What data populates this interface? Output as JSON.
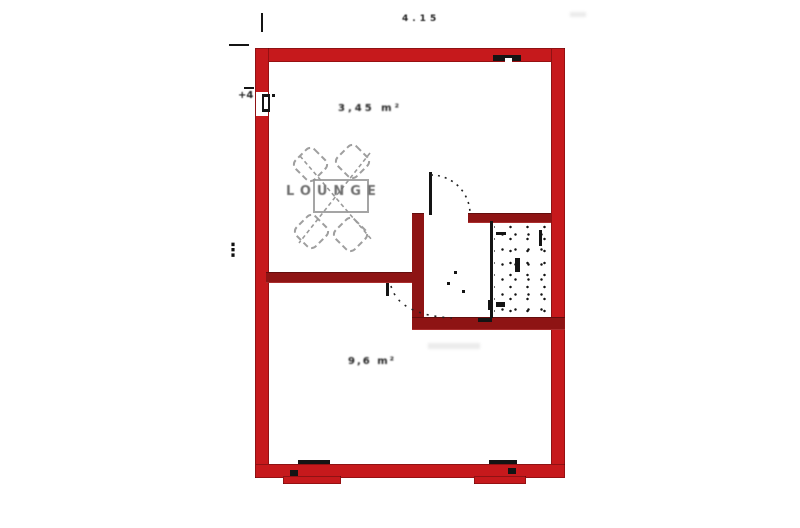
{
  "labels": {
    "top_dimension": "4.15",
    "upper_room_dimension": "3,45 m²",
    "upper_room_name": "LOUNGE",
    "lower_room_dimension": "9,6 m²",
    "level_marker": "+4",
    "left_dimension_marks": "⋮"
  },
  "colors": {
    "background": "#ffffff",
    "wall_outer": "#c6191c",
    "wall_inner": "#8e1414",
    "ink": "#141414",
    "furniture": "#8f8f8f"
  }
}
